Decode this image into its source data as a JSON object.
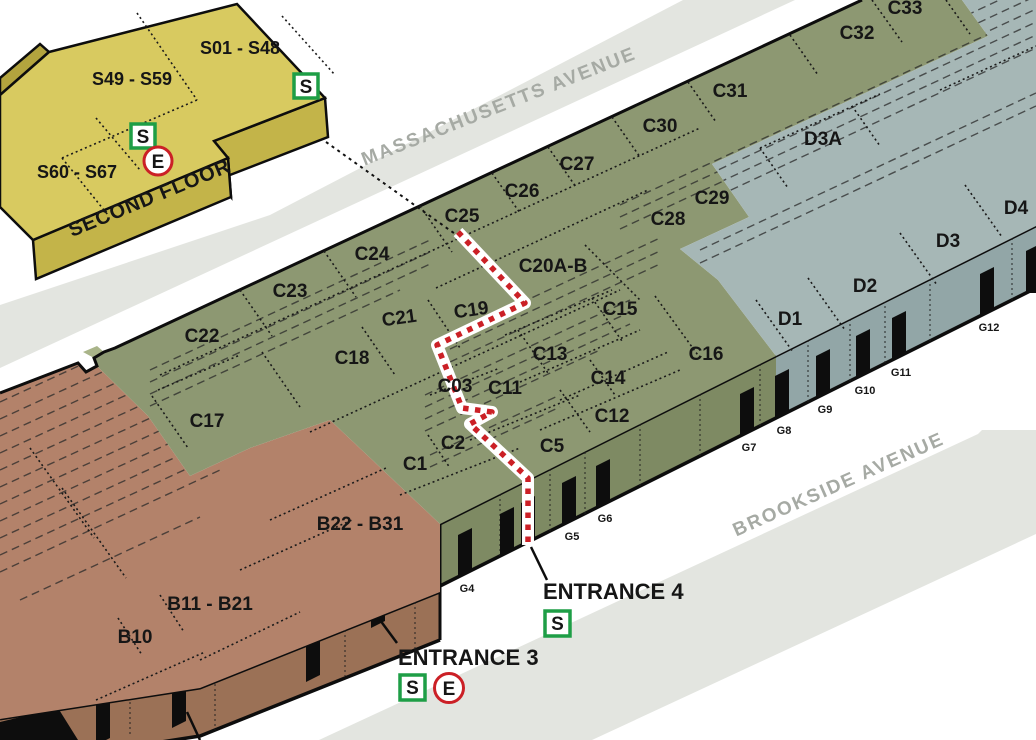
{
  "map": {
    "streets": {
      "massachusetts": "MASSACHUSETTS AVENUE",
      "brookside": "BROOKSIDE AVENUE"
    },
    "second_floor": {
      "title": "SECOND FLOOR",
      "rooms": {
        "r1": "S01 - S48",
        "r2": "S49 - S59",
        "r3": "S60 - S67"
      }
    },
    "rooms": {
      "b10": "B10",
      "b11": "B11 - B21",
      "b22": "B22 - B31",
      "c1": "C1",
      "c2": "C2",
      "c03": "C03",
      "c5": "C5",
      "c11": "C11",
      "c12": "C12",
      "c13": "C13",
      "c14": "C14",
      "c15": "C15",
      "c16": "C16",
      "c17": "C17",
      "c18": "C18",
      "c19": "C19",
      "c20": "C20A-B",
      "c21": "C21",
      "c22": "C22",
      "c23": "C23",
      "c24": "C24",
      "c25": "C25",
      "c26": "C26",
      "c27": "C27",
      "c28": "C28",
      "c29": "C29",
      "c30": "C30",
      "c31": "C31",
      "c32": "C32",
      "c33": "C33",
      "d1": "D1",
      "d2": "D2",
      "d3": "D3",
      "d3a": "D3A",
      "d4": "D4"
    },
    "doors": {
      "g4": "G4",
      "g5": "G5",
      "g6": "G6",
      "g7": "G7",
      "g8": "G8",
      "g9": "G9",
      "g10": "G10",
      "g11": "G11",
      "g12": "G12"
    },
    "entrances": {
      "e3": "ENTRANCE 3",
      "e4": "ENTRANCE 4"
    },
    "icons": {
      "stairs": "S",
      "elevator": "E"
    },
    "colors": {
      "second_floor_roof": "#d8ca60",
      "second_floor_face": "#c3b449",
      "section_b_roof": "#b3826a",
      "section_b_face": "#9b7156",
      "section_c_roof": "#8d9872",
      "section_c_face": "#7e8a63",
      "section_d_roof": "#a6b7b6",
      "section_d_face": "#92a6a7",
      "road": "#e3e5e0",
      "route": "#cb2026",
      "stairs_green": "#1e9e46",
      "elevator_red": "#cb2026"
    }
  }
}
